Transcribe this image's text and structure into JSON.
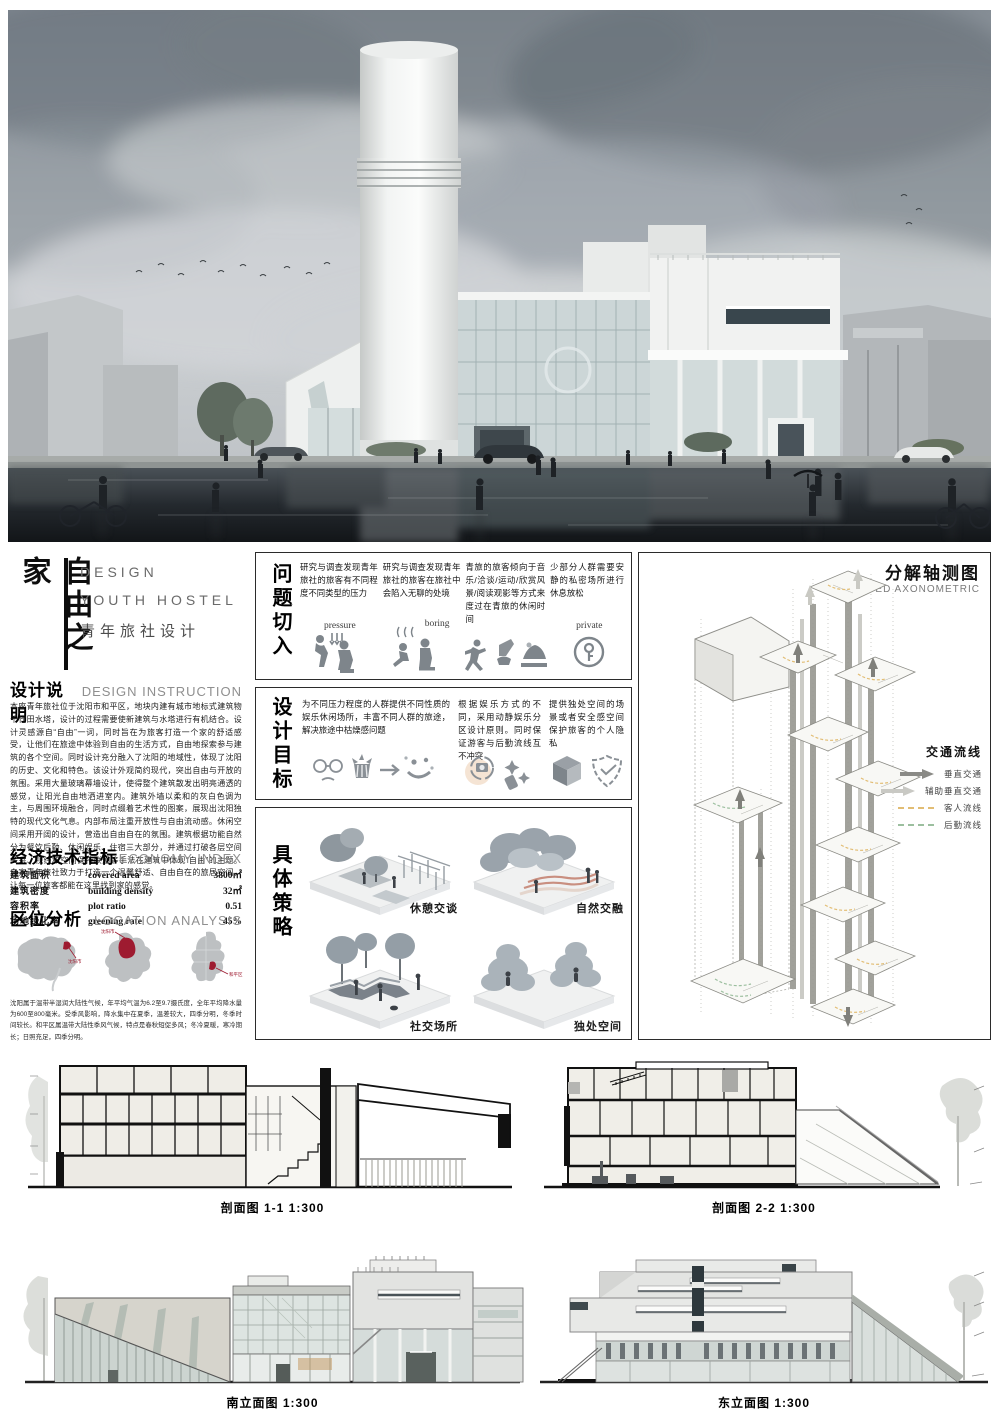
{
  "title_block": {
    "vertical_title": "自由之家",
    "subtitle_lines": [
      "DESIGN",
      "YOUTH HOSTEL",
      "青年旅社设计"
    ]
  },
  "design_instruction": {
    "heading_zh": "设计说明",
    "heading_en": "DESIGN INSTRUCTION",
    "body": "本座青年旅社位于沈阳市和平区，地块内建有城市地标式建筑物千代田水塔，设计的过程需要使新建筑与水塔进行有机结合。设计灵感源自“自由”一词，同时旨在为旅客打造一个家的舒适感受，让他们在旅途中体验到自由的生活方式，自由地探索参与建筑的各个空间。同时设计充分融入了沈阳的地域性，体现了沈阳的历史、文化和特色。该设计外观简约现代，突出自由与开放的氛围。采用大量玻璃幕墙设计，使得整个建筑散发出明亮通透的感觉，让阳光自由地洒进室内。建筑外墙以柔和的灰白色调为主，与周围环境融合，同时点缀着艺术性的图案，展现出沈阳独特的现代文化气息。内部布局注重开放性与自由流动感。休闲空间采用开阔的设计，营造出自由自在的氛围。建筑根据功能自然分为餐饮后勤、休闲娱乐、住宿三大部分，并通过打破各层空间关系、视线和空间保持联通等手法在建筑中体现“自由”的主题。自家青年旅社致力于打造一个温馨舒适、自由自在的旅居空间，让每一位旅客都能在这里找到家的感觉。"
  },
  "economy_index": {
    "heading_zh": "经济技术指标",
    "heading_en": "ECONOMY INDEX",
    "rows": [
      {
        "zh": "建筑面积",
        "en": "covered area",
        "value": "3800㎡"
      },
      {
        "zh": "建筑密度",
        "en": "building density",
        "value": "32㎡"
      },
      {
        "zh": "容积率",
        "en": "plot ratio",
        "value": "0.51"
      },
      {
        "zh": "场地绿化率",
        "en": "greening rate",
        "value": "45%"
      }
    ]
  },
  "location_analysis": {
    "heading_zh": "区位分析",
    "heading_en": "LOCATION ANALYSIS",
    "maps": [
      {
        "label": "沈阳市"
      },
      {
        "label": "沈阳市"
      },
      {
        "label": "和平区"
      }
    ],
    "caption": "沈阳属于温带半湿润大陆性气候，年平均气温为6.2至9.7摄氏度，全年平均降水量为600至800毫米。受季风影响，降水集中在夏季，温差较大，四季分明，冬季时间较长。和平区属温带大陆性季风气候，特点是春秋短促多风；冬冷夏暖，寒冷期长；日照充足，四季分明。"
  },
  "problem_section": {
    "heading": "问题切入",
    "items": [
      {
        "text": "研究与调查发现青年旅社的旅客有不同程度不同类型的压力",
        "icon_label": "pressure",
        "icon": "pressure-icon"
      },
      {
        "text": "研究与调查发现青年旅社的旅客在旅社中会陷入无聊的处境",
        "icon_label": "boring",
        "icon": "boring-icon"
      },
      {
        "text": "青旅的旅客倾向于音乐/洽谈/运动/欣赏风景/阅读观影等方式来度过在青旅的休闲时间",
        "icon_label": "",
        "icon": "leisure-icons"
      },
      {
        "text": "少部分人群需要安静的私密场所进行休息放松",
        "icon_label": "private",
        "icon": "private-key-icon"
      }
    ]
  },
  "goal_section": {
    "heading": "设计目标",
    "items": [
      {
        "text": "为不同压力程度的人群提供不同性质的娱乐休闲场所，丰富不同人群的旅途，解决旅途中枯燥感问题",
        "icons": "sad-face-icon popcorn-icon arrow-icon happy-face-icon"
      },
      {
        "text": "根据娱乐方式的不同，采用动静娱乐分区设计原则。同时保证游客与后勤流线互不冲突",
        "icons": "photo-icon sparkles-icon"
      },
      {
        "text": "提供独处空间的场景或者安全感空间保护旅客的个人隐私",
        "icons": "cube-icon shield-icon"
      }
    ]
  },
  "strategy_section": {
    "heading": "具体策略",
    "items": [
      {
        "label": "休憩交谈"
      },
      {
        "label": "自然交融"
      },
      {
        "label": "社交场所"
      },
      {
        "label": "独处空间"
      }
    ]
  },
  "axonometric": {
    "heading_zh": "分解轴测图",
    "heading_en": "EXPLODED AXONOMETRIC",
    "legend_title": "交通流线",
    "legend_items": [
      {
        "label": "垂直交通",
        "type": "arrow-dark",
        "color": "#8a8a86"
      },
      {
        "label": "辅助垂直交通",
        "type": "arrow-light",
        "color": "#c9c9c4"
      },
      {
        "label": "客人流线",
        "type": "dash-yellow",
        "color": "#e2be74"
      },
      {
        "label": "后勤流线",
        "type": "dash-green",
        "color": "#9cbf9f"
      }
    ]
  },
  "drawings": {
    "section_1_label": "剖面图  1-1  1:300",
    "section_2_label": "剖面图  2-2  1:300",
    "south_elevation_label": "南立面图  1:300",
    "east_elevation_label": "东立面图  1:300"
  }
}
